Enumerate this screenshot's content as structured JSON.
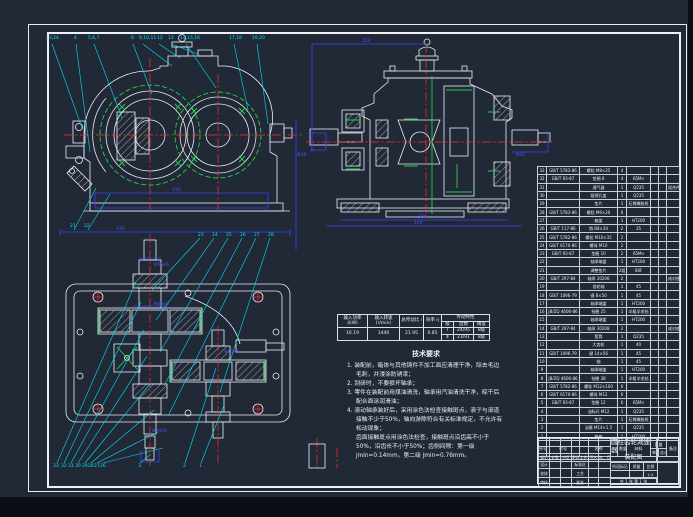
{
  "colors": {
    "background": "#222936",
    "line_white": "#e9eef4",
    "centerline_red": "#ff2b2b",
    "leader_cyan": "#00e0ff",
    "dimension_blue": "#3742ff",
    "highlight_green": "#23d14b"
  },
  "callouts_top": [
    {
      "t": "23,24"
    },
    {
      "t": "4"
    },
    {
      "t": "5,6,7"
    },
    {
      "t": "8"
    },
    {
      "t": "9,10,11"
    },
    {
      "t": "12"
    },
    {
      "t": "13"
    },
    {
      "t": "14,15,16"
    },
    {
      "t": "17,18"
    },
    {
      "t": "19,20"
    }
  ],
  "callouts_plan_top": [
    {
      "t": "21"
    },
    {
      "t": "22"
    },
    {
      "t": "23"
    },
    {
      "t": "24"
    },
    {
      "t": "25"
    },
    {
      "t": "26"
    },
    {
      "t": "27"
    },
    {
      "t": "28"
    }
  ],
  "callouts_bottom": [
    {
      "t": "33"
    },
    {
      "t": "32"
    },
    {
      "t": "31"
    },
    {
      "t": "30"
    },
    {
      "t": "29"
    },
    {
      "t": "28"
    },
    {
      "t": "27"
    },
    {
      "t": "26"
    },
    {
      "t": "3"
    },
    {
      "t": "2"
    },
    {
      "t": "1"
    }
  ],
  "dim_labels": [
    {
      "t": "430"
    },
    {
      "t": "254"
    },
    {
      "t": "380"
    },
    {
      "t": "440"
    },
    {
      "t": "Φ38"
    },
    {
      "t": "Φ42"
    },
    {
      "t": "430"
    },
    {
      "t": "Φ55k6"
    },
    {
      "t": "Φ45k6"
    },
    {
      "t": "Φ40k6"
    },
    {
      "t": "Φ30k6"
    }
  ],
  "spec": {
    "h_power": "输入功率 (kW)",
    "h_speed": "输入转速 (r/min)",
    "h_ratio": "总传动比 i",
    "h_eff": "效率 η",
    "h_group": "传动特性",
    "h_stage": "级",
    "h_teeth": "齿数",
    "h_acc": "精度",
    "v_power": "16.19",
    "v_speed": "1440",
    "v_ratio": "21.95",
    "v_eff": "0.85",
    "s1": "Ⅰ",
    "s1_teeth": "24/95",
    "s1_acc": "8级",
    "s2": "Ⅱ",
    "s2_teeth": "23/91",
    "s2_acc": "8级"
  },
  "tech_req": {
    "title": "技术要求",
    "items": [
      {
        "t": "1. 装配前，箱体与其他铸件不加工面应清理干净，除去毛边毛刺，并浸涂防锈漆；"
      },
      {
        "t": "2. 刮研时，不要损坏轴承；"
      },
      {
        "t": "3. 零件在装配前用煤油清洗，轴承用汽油清洗干净，晾干后配合面涂润滑油；"
      },
      {
        "t": "4. 滚动轴承装好后，采用涂色法检查接触斑点，滚子与滚道接触不少于50%，轴向游隙符合有关标准规定，不允许有松动现象；\n齿面接触斑点用涂色法检查，接触斑点沿齿高不小于50%，沿齿长不小于50%；齿侧间隙：第一级 jmin=0.14mm，第二级 jmin=0.76mm。"
      }
    ]
  },
  "bom": {
    "h_no": "序号",
    "h_code": "代号",
    "h_name": "名称",
    "h_qty": "数量",
    "h_mat": "材料",
    "h_weight": "重量",
    "h_w1": "单件",
    "h_w2": "总计",
    "h_rem": "备注",
    "rows": [
      {
        "n": "33",
        "code": "GB/T 5783-86",
        "name": "螺栓 M8×25",
        "qty": "4",
        "mat": "",
        "w1": "",
        "w2": "",
        "rem": ""
      },
      {
        "n": "32",
        "code": "GB/T 93-87",
        "name": "垫圈 8",
        "qty": "4",
        "mat": "65Mn",
        "w1": "",
        "w2": "",
        "rem": ""
      },
      {
        "n": "31",
        "code": "",
        "name": "通气器",
        "qty": "1",
        "mat": "Q235",
        "w1": "",
        "w2": "",
        "rem": "组合件"
      },
      {
        "n": "30",
        "code": "",
        "name": "窥视孔盖",
        "qty": "1",
        "mat": "Q235",
        "w1": "",
        "w2": "",
        "rem": ""
      },
      {
        "n": "29",
        "code": "",
        "name": "垫片",
        "qty": "1",
        "mat": "石棉橡胶纸",
        "w1": "",
        "w2": "",
        "rem": ""
      },
      {
        "n": "28",
        "code": "GB/T 5783-86",
        "name": "螺栓 M6×20",
        "qty": "6",
        "mat": "",
        "w1": "",
        "w2": "",
        "rem": ""
      },
      {
        "n": "27",
        "code": "",
        "name": "箱盖",
        "qty": "1",
        "mat": "HT200",
        "w1": "",
        "w2": "",
        "rem": ""
      },
      {
        "n": "26",
        "code": "GB/T 117-86",
        "name": "销 B8×30",
        "qty": "2",
        "mat": "35",
        "w1": "",
        "w2": "",
        "rem": ""
      },
      {
        "n": "25",
        "code": "GB/T 5782-86",
        "name": "螺栓 M10×35",
        "qty": "2",
        "mat": "",
        "w1": "",
        "w2": "",
        "rem": ""
      },
      {
        "n": "24",
        "code": "GB/T 6170-86",
        "name": "螺母 M10",
        "qty": "2",
        "mat": "",
        "w1": "",
        "w2": "",
        "rem": ""
      },
      {
        "n": "23",
        "code": "GB/T 93-87",
        "name": "垫圈 10",
        "qty": "2",
        "mat": "65Mn",
        "w1": "",
        "w2": "",
        "rem": ""
      },
      {
        "n": "22",
        "code": "",
        "name": "轴承端盖",
        "qty": "1",
        "mat": "HT200",
        "w1": "",
        "w2": "",
        "rem": ""
      },
      {
        "n": "21",
        "code": "",
        "name": "调整垫片",
        "qty": "2组",
        "mat": "08F",
        "w1": "",
        "w2": "",
        "rem": ""
      },
      {
        "n": "20",
        "code": "GB/T 297-84",
        "name": "轴承 30206",
        "qty": "2",
        "mat": "",
        "w1": "",
        "w2": "",
        "rem": "成对使用"
      },
      {
        "n": "19",
        "code": "",
        "name": "齿轮轴",
        "qty": "1",
        "mat": "45",
        "w1": "",
        "w2": "",
        "rem": ""
      },
      {
        "n": "18",
        "code": "GB/T 1096-79",
        "name": "键 8×50",
        "qty": "1",
        "mat": "45",
        "w1": "",
        "w2": "",
        "rem": ""
      },
      {
        "n": "17",
        "code": "",
        "name": "轴承端盖",
        "qty": "1",
        "mat": "HT200",
        "w1": "",
        "w2": "",
        "rem": ""
      },
      {
        "n": "16",
        "code": "JB/ZQ 4606-86",
        "name": "毡圈 25",
        "qty": "1",
        "mat": "半粗羊毛毡",
        "w1": "",
        "w2": "",
        "rem": ""
      },
      {
        "n": "15",
        "code": "",
        "name": "轴承端盖",
        "qty": "1",
        "mat": "HT200",
        "w1": "",
        "w2": "",
        "rem": ""
      },
      {
        "n": "14",
        "code": "GB/T 297-84",
        "name": "轴承 30208",
        "qty": "2",
        "mat": "",
        "w1": "",
        "w2": "",
        "rem": "成对使用"
      },
      {
        "n": "13",
        "code": "",
        "name": "套筒",
        "qty": "1",
        "mat": "Q235",
        "w1": "",
        "w2": "",
        "rem": ""
      },
      {
        "n": "12",
        "code": "",
        "name": "大齿轮",
        "qty": "1",
        "mat": "40",
        "w1": "",
        "w2": "",
        "rem": ""
      },
      {
        "n": "11",
        "code": "GB/T 1096-79",
        "name": "键 14×56",
        "qty": "1",
        "mat": "45",
        "w1": "",
        "w2": "",
        "rem": ""
      },
      {
        "n": "10",
        "code": "",
        "name": "轴",
        "qty": "1",
        "mat": "45",
        "w1": "",
        "w2": "",
        "rem": ""
      },
      {
        "n": "9",
        "code": "",
        "name": "轴承端盖",
        "qty": "1",
        "mat": "HT200",
        "w1": "",
        "w2": "",
        "rem": ""
      },
      {
        "n": "8",
        "code": "JB/ZQ 4606-86",
        "name": "毡圈 38",
        "qty": "1",
        "mat": "半粗羊毛毡",
        "w1": "",
        "w2": "",
        "rem": ""
      },
      {
        "n": "7",
        "code": "GB/T 5782-86",
        "name": "螺栓 M12×100",
        "qty": "6",
        "mat": "",
        "w1": "",
        "w2": "",
        "rem": ""
      },
      {
        "n": "6",
        "code": "GB/T 6170-86",
        "name": "螺母 M12",
        "qty": "6",
        "mat": "",
        "w1": "",
        "w2": "",
        "rem": ""
      },
      {
        "n": "5",
        "code": "GB/T 93-87",
        "name": "垫圈 12",
        "qty": "6",
        "mat": "65Mn",
        "w1": "",
        "w2": "",
        "rem": ""
      },
      {
        "n": "4",
        "code": "",
        "name": "油标尺 M12",
        "qty": "1",
        "mat": "Q235",
        "w1": "",
        "w2": "",
        "rem": ""
      },
      {
        "n": "3",
        "code": "",
        "name": "垫片",
        "qty": "1",
        "mat": "石棉橡胶纸",
        "w1": "",
        "w2": "",
        "rem": ""
      },
      {
        "n": "2",
        "code": "",
        "name": "油塞 M14×1.5",
        "qty": "1",
        "mat": "Q235",
        "w1": "",
        "w2": "",
        "rem": ""
      },
      {
        "n": "1",
        "code": "",
        "name": "箱座",
        "qty": "1",
        "mat": "HT200",
        "w1": "",
        "w2": "",
        "rem": ""
      }
    ]
  },
  "title_block": {
    "title1": "圆柱齿轮减速器",
    "title2": "装配图",
    "grid_top": [
      {
        "c0": "",
        "c1": "",
        "c2": "",
        "c3": "",
        "c4": "",
        "c5": ""
      },
      {
        "c0": "",
        "c1": "",
        "c2": "",
        "c3": "",
        "c4": "",
        "c5": ""
      },
      {
        "c0": "标记",
        "c1": "处数",
        "c2": "分区",
        "c3": "更改文件号",
        "c4": "签名",
        "c5": "年、月、日"
      }
    ],
    "grid_bot": [
      {
        "c0": "设计",
        "c1": "",
        "c2": "",
        "c3": "标准化",
        "c4": "",
        "c5": ""
      },
      {
        "c0": "校核",
        "c1": "",
        "c2": "",
        "c3": "工艺",
        "c4": "",
        "c5": ""
      },
      {
        "c0": "审核",
        "c1": "",
        "c2": "",
        "c3": "批准",
        "c4": "",
        "c5": ""
      }
    ],
    "mid": [
      {
        "c0": "阶段标记",
        "c1": "质量",
        "c2": "比例"
      },
      {
        "c0": "",
        "c1": "",
        "c2": "1:2"
      }
    ],
    "sheets": "共 1 张  第 1 张"
  }
}
